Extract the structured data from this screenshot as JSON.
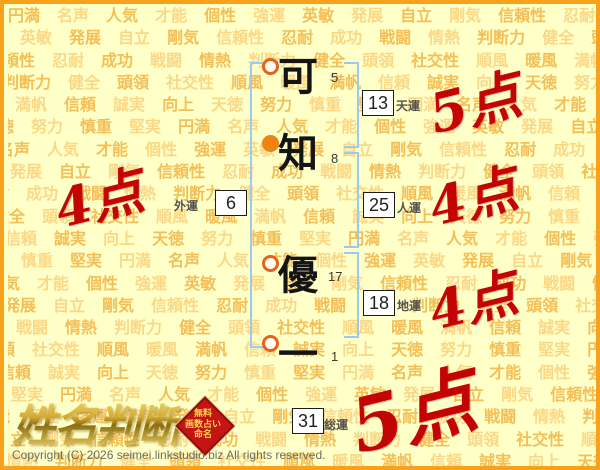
{
  "background": {
    "words": [
      "円満",
      "名声",
      "人気",
      "才能",
      "個性",
      "強運",
      "英敏",
      "発展",
      "自立",
      "剛気",
      "信頼性",
      "忍耐",
      "成功",
      "戦闘",
      "情熱",
      "判断力",
      "健全",
      "頭領",
      "社交性",
      "順風",
      "暖風",
      "満帆",
      "信頼",
      "誠実",
      "向上",
      "天徳",
      "努力",
      "慎重",
      "堅実"
    ]
  },
  "name": {
    "chars": [
      {
        "glyph": "可",
        "strokes": "5",
        "marker": "ring"
      },
      {
        "glyph": "知",
        "strokes": "8",
        "marker": "filled"
      },
      {
        "glyph": "優",
        "strokes": "17",
        "marker": "ring"
      },
      {
        "glyph": "一",
        "strokes": "1",
        "marker": "ring"
      }
    ]
  },
  "fortunes": {
    "ten": {
      "value": "13",
      "label": "天運",
      "score": "5点"
    },
    "jin": {
      "value": "25",
      "label": "人運",
      "score": "4点"
    },
    "chi": {
      "value": "18",
      "label": "地運",
      "score": "4点"
    },
    "gai": {
      "value": "6",
      "label": "外運",
      "score": "4点"
    },
    "sou": {
      "value": "31",
      "label": "総運",
      "score": "5点"
    }
  },
  "logo": {
    "title": "姓名判断",
    "badge_lines": [
      "無料",
      "画数占い",
      "命名"
    ]
  },
  "footer": {
    "copyright": "Copyright (C) 2026 seimei.linkstudio.biz All rights reserved."
  },
  "colors": {
    "accent_red": "#c40404",
    "border_orange": "#f7a11c",
    "bracket_blue": "#9cc9f2",
    "background": "#ffffc8"
  }
}
